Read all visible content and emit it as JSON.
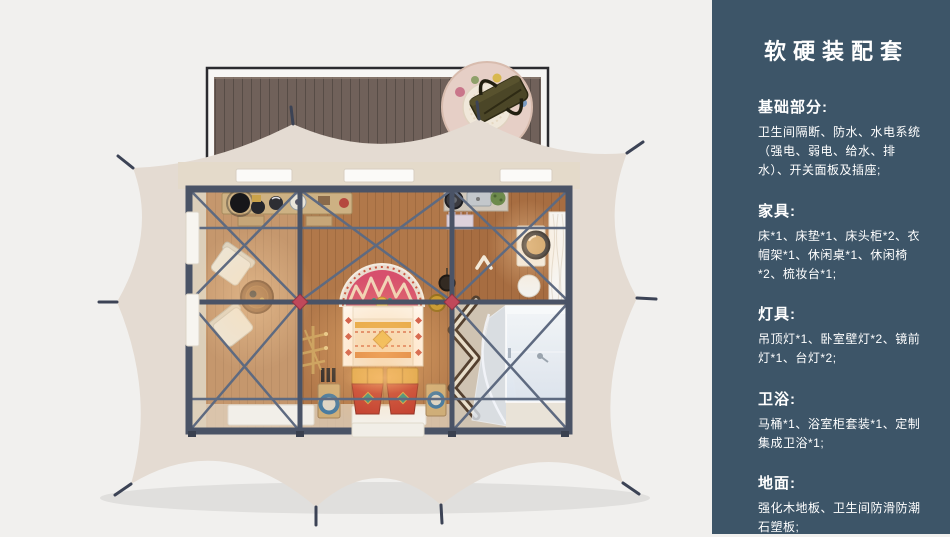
{
  "panel": {
    "title": "软硬装配套",
    "sections": [
      {
        "heading": "基础部分:",
        "body": "卫生间隔断、防水、水电系统（强电、弱电、给水、排水）、开关面板及插座;"
      },
      {
        "heading": "家具:",
        "body": "床*1、床垫*1、床头柜*2、衣帽架*1、休闲桌*1、休闲椅*2、梳妆台*1;"
      },
      {
        "heading": "灯具:",
        "body": "吊顶灯*1、卧室壁灯*2、镜前灯*1、台灯*2;"
      },
      {
        "heading": "卫浴:",
        "body": "马桶*1、浴室柜套装*1、定制集成卫浴*1;"
      },
      {
        "heading": "地面:",
        "body": "强化木地板、卫生间防滑防潮石塑板;"
      }
    ]
  },
  "colors": {
    "page-bg": "#f1f0ee",
    "panel-bg": "#3d5568",
    "panel-text": "#ffffff",
    "tent-canvas": "#e4dbd2",
    "frame": "#4a5366",
    "frame-light": "#5e6a80",
    "floor-wood": "#b1784a",
    "deck-wood": "#70615a",
    "rug-red": "#d7506d",
    "hub-red": "#c0485a",
    "chest-red": "#c13a2d",
    "gold": "#d9a441",
    "glass": "#e7ecf3"
  }
}
